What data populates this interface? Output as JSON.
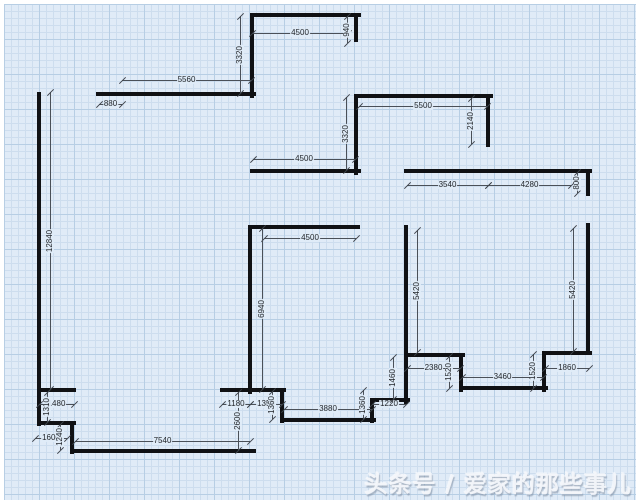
{
  "watermark": {
    "text": "头条号 / 爱家的那些事儿"
  },
  "colors": {
    "wall": "#101114",
    "dimension": "#4a5058",
    "grid_background": "#e0ebf7",
    "grid_minor": "#cdddee",
    "grid_major": "#b7cee4",
    "watermark": "#f3f6fa"
  },
  "plan": {
    "unit": "mm",
    "walls": [
      {
        "x1": 252,
        "y1": 15,
        "x2": 359,
        "y2": 15
      },
      {
        "x1": 252,
        "y1": 15,
        "x2": 252,
        "y2": 96
      },
      {
        "x1": 356,
        "y1": 15,
        "x2": 356,
        "y2": 40
      },
      {
        "x1": 98,
        "y1": 94,
        "x2": 254,
        "y2": 94
      },
      {
        "x1": 39,
        "y1": 94,
        "x2": 39,
        "y2": 392
      },
      {
        "x1": 356,
        "y1": 96,
        "x2": 491,
        "y2": 96
      },
      {
        "x1": 488,
        "y1": 96,
        "x2": 488,
        "y2": 145
      },
      {
        "x1": 356,
        "y1": 96,
        "x2": 356,
        "y2": 173
      },
      {
        "x1": 252,
        "y1": 171,
        "x2": 359,
        "y2": 171
      },
      {
        "x1": 406,
        "y1": 171,
        "x2": 590,
        "y2": 171
      },
      {
        "x1": 588,
        "y1": 171,
        "x2": 588,
        "y2": 194
      },
      {
        "x1": 252,
        "y1": 227,
        "x2": 358,
        "y2": 227
      },
      {
        "x1": 250,
        "y1": 227,
        "x2": 250,
        "y2": 392
      },
      {
        "x1": 406,
        "y1": 227,
        "x2": 406,
        "y2": 402
      },
      {
        "x1": 588,
        "y1": 225,
        "x2": 588,
        "y2": 353
      },
      {
        "x1": 39,
        "y1": 390,
        "x2": 74,
        "y2": 390
      },
      {
        "x1": 39,
        "y1": 390,
        "x2": 39,
        "y2": 424
      },
      {
        "x1": 39,
        "y1": 423,
        "x2": 74,
        "y2": 423
      },
      {
        "x1": 72,
        "y1": 423,
        "x2": 72,
        "y2": 452
      },
      {
        "x1": 72,
        "y1": 451,
        "x2": 254,
        "y2": 451
      },
      {
        "x1": 222,
        "y1": 390,
        "x2": 284,
        "y2": 390
      },
      {
        "x1": 282,
        "y1": 390,
        "x2": 282,
        "y2": 421
      },
      {
        "x1": 282,
        "y1": 420,
        "x2": 374,
        "y2": 420
      },
      {
        "x1": 372,
        "y1": 400,
        "x2": 372,
        "y2": 421
      },
      {
        "x1": 372,
        "y1": 400,
        "x2": 408,
        "y2": 400
      },
      {
        "x1": 406,
        "y1": 355,
        "x2": 463,
        "y2": 355
      },
      {
        "x1": 461,
        "y1": 355,
        "x2": 461,
        "y2": 390
      },
      {
        "x1": 461,
        "y1": 388,
        "x2": 546,
        "y2": 388
      },
      {
        "x1": 544,
        "y1": 353,
        "x2": 544,
        "y2": 390
      },
      {
        "x1": 544,
        "y1": 353,
        "x2": 590,
        "y2": 353
      }
    ],
    "dimensions": [
      {
        "label": "4500",
        "x1": 252,
        "y1": 33,
        "x2": 348,
        "y2": 33
      },
      {
        "label": "940",
        "x1": 347,
        "y1": 16,
        "x2": 347,
        "y2": 43
      },
      {
        "label": "3320",
        "x1": 240,
        "y1": 16,
        "x2": 240,
        "y2": 93
      },
      {
        "label": "5560",
        "x1": 122,
        "y1": 80,
        "x2": 251,
        "y2": 80
      },
      {
        "label": "880",
        "x1": 99,
        "y1": 104,
        "x2": 122,
        "y2": 104
      },
      {
        "label": "12840",
        "x1": 50,
        "y1": 92,
        "x2": 50,
        "y2": 389
      },
      {
        "label": "5500",
        "x1": 359,
        "y1": 106,
        "x2": 487,
        "y2": 106
      },
      {
        "label": "2140",
        "x1": 471,
        "y1": 98,
        "x2": 471,
        "y2": 144
      },
      {
        "label": "3320",
        "x1": 346,
        "y1": 97,
        "x2": 346,
        "y2": 170
      },
      {
        "label": "4500",
        "x1": 253,
        "y1": 159,
        "x2": 355,
        "y2": 159
      },
      {
        "label": "3540",
        "x1": 407,
        "y1": 185,
        "x2": 488,
        "y2": 185
      },
      {
        "label": "4280",
        "x1": 488,
        "y1": 185,
        "x2": 571,
        "y2": 185
      },
      {
        "label": "800",
        "x1": 577,
        "y1": 172,
        "x2": 577,
        "y2": 193
      },
      {
        "label": "4500",
        "x1": 264,
        "y1": 238,
        "x2": 356,
        "y2": 238
      },
      {
        "label": "6940",
        "x1": 262,
        "y1": 228,
        "x2": 262,
        "y2": 389
      },
      {
        "label": "5420",
        "x1": 417,
        "y1": 230,
        "x2": 417,
        "y2": 352
      },
      {
        "label": "5420",
        "x1": 573,
        "y1": 228,
        "x2": 573,
        "y2": 351
      },
      {
        "label": "1480",
        "x1": 39,
        "y1": 404,
        "x2": 74,
        "y2": 404
      },
      {
        "label": "1310",
        "x1": 47,
        "y1": 392,
        "x2": 47,
        "y2": 422
      },
      {
        "label": "1600",
        "x1": 35,
        "y1": 438,
        "x2": 67,
        "y2": 438
      },
      {
        "label": "1240",
        "x1": 60,
        "y1": 424,
        "x2": 60,
        "y2": 450
      },
      {
        "label": "7540",
        "x1": 75,
        "y1": 441,
        "x2": 250,
        "y2": 441
      },
      {
        "label": "2600",
        "x1": 238,
        "y1": 392,
        "x2": 238,
        "y2": 450
      },
      {
        "label": "1180",
        "x1": 222,
        "y1": 404,
        "x2": 250,
        "y2": 404
      },
      {
        "label": "1350",
        "x1": 250,
        "y1": 404,
        "x2": 282,
        "y2": 404
      },
      {
        "label": "1360",
        "x1": 272,
        "y1": 391,
        "x2": 272,
        "y2": 419
      },
      {
        "label": "3880",
        "x1": 284,
        "y1": 409,
        "x2": 372,
        "y2": 409
      },
      {
        "label": "1360",
        "x1": 363,
        "y1": 390,
        "x2": 363,
        "y2": 419
      },
      {
        "label": "1220",
        "x1": 372,
        "y1": 404,
        "x2": 406,
        "y2": 404
      },
      {
        "label": "1460",
        "x1": 393,
        "y1": 357,
        "x2": 393,
        "y2": 399
      },
      {
        "label": "2380",
        "x1": 407,
        "y1": 368,
        "x2": 460,
        "y2": 368
      },
      {
        "label": "1520",
        "x1": 449,
        "y1": 356,
        "x2": 449,
        "y2": 388
      },
      {
        "label": "3460",
        "x1": 462,
        "y1": 377,
        "x2": 543,
        "y2": 377
      },
      {
        "label": "1520",
        "x1": 533,
        "y1": 354,
        "x2": 533,
        "y2": 388
      },
      {
        "label": "1860",
        "x1": 545,
        "y1": 368,
        "x2": 589,
        "y2": 368
      }
    ]
  }
}
